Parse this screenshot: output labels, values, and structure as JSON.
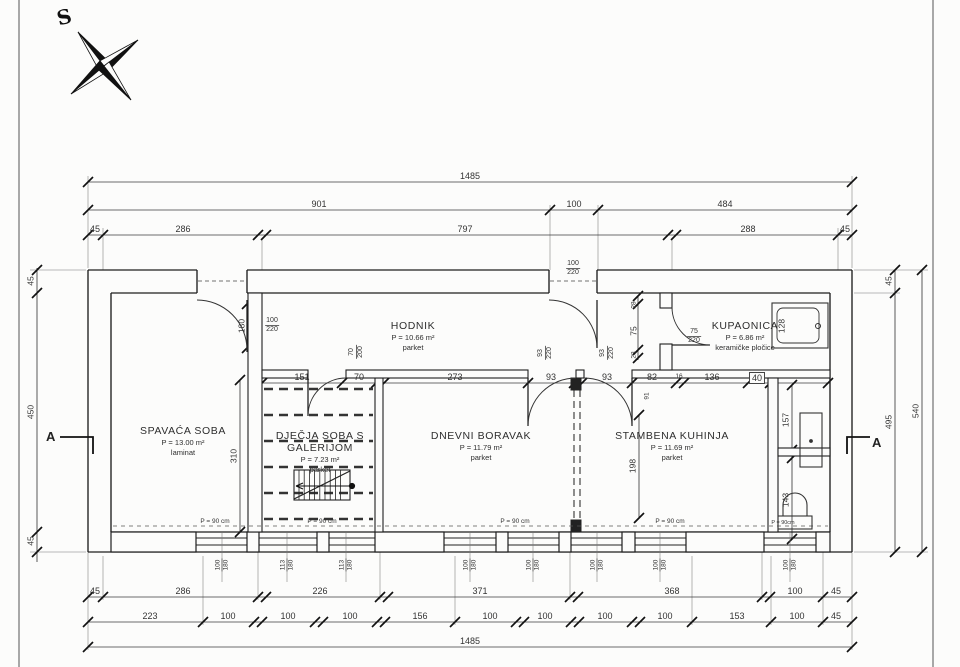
{
  "sheet": {
    "compass_label": "S",
    "section_label": "A"
  },
  "rooms": [
    {
      "name": "SPAVAĆA SOBA",
      "area": "P = 13.00 m²",
      "floor": "laminat"
    },
    {
      "name": "DJEČJA SOBA S",
      "name2": "GALERIJOM",
      "area": "P = 7.23 m²",
      "floor": "parket"
    },
    {
      "name": "HODNIK",
      "area": "P = 10.66 m²",
      "floor": "parket"
    },
    {
      "name": "DNEVNI BORAVAK",
      "area": "P = 11.79 m²",
      "floor": "parket"
    },
    {
      "name": "STAMBENA KUHINJA",
      "area": "P = 11.69 m²",
      "floor": "parket"
    },
    {
      "name": "KUPAONICA",
      "area": "P = 6.86 m²",
      "floor": "keramičke pločice"
    }
  ],
  "dims": {
    "top_total": [
      "1485"
    ],
    "top_mid": [
      "901",
      "100",
      "484"
    ],
    "top_detail": [
      "45",
      "286",
      "797",
      "288",
      "45"
    ],
    "bottom_main": [
      "45",
      "286",
      "226",
      "371",
      "368",
      "100",
      "45"
    ],
    "bottom_detail": [
      "223",
      "100",
      "100",
      "100",
      "156",
      "100",
      "100",
      "100",
      "100",
      "153",
      "100",
      "45"
    ],
    "bottom_total": [
      "1485"
    ],
    "left": [
      "45",
      "450",
      "45"
    ],
    "right_inner": [
      "45",
      "495"
    ],
    "right_outer": [
      "540"
    ],
    "interior_horizontal": [
      "151",
      "70",
      "273",
      "93",
      "93",
      "82",
      "16",
      "136",
      "40"
    ],
    "interior_vertical": [
      "310",
      "198",
      "157",
      "143",
      "91",
      "128",
      "180",
      "75",
      "28",
      "28"
    ]
  },
  "door_labels": [
    {
      "w": "100",
      "h": "220"
    },
    {
      "w": "100",
      "h": "220"
    },
    {
      "w": "75",
      "h": "220"
    },
    {
      "w": "70",
      "h": "200"
    },
    {
      "w": "93",
      "h": "220"
    },
    {
      "w": "93",
      "h": "220"
    }
  ],
  "window_labels": [
    {
      "w": "100",
      "h": "180"
    },
    {
      "w": "113",
      "h": "180"
    },
    {
      "w": "113",
      "h": "180"
    },
    {
      "w": "100",
      "h": "180"
    },
    {
      "w": "100",
      "h": "180"
    },
    {
      "w": "100",
      "h": "180"
    },
    {
      "w": "100",
      "h": "180"
    },
    {
      "w": "100",
      "h": "180"
    }
  ],
  "parapet_labels": [
    "P = 90 cm",
    "P = 90 cm",
    "P = 90 cm",
    "P = 90 cm",
    "P = 90cm"
  ]
}
